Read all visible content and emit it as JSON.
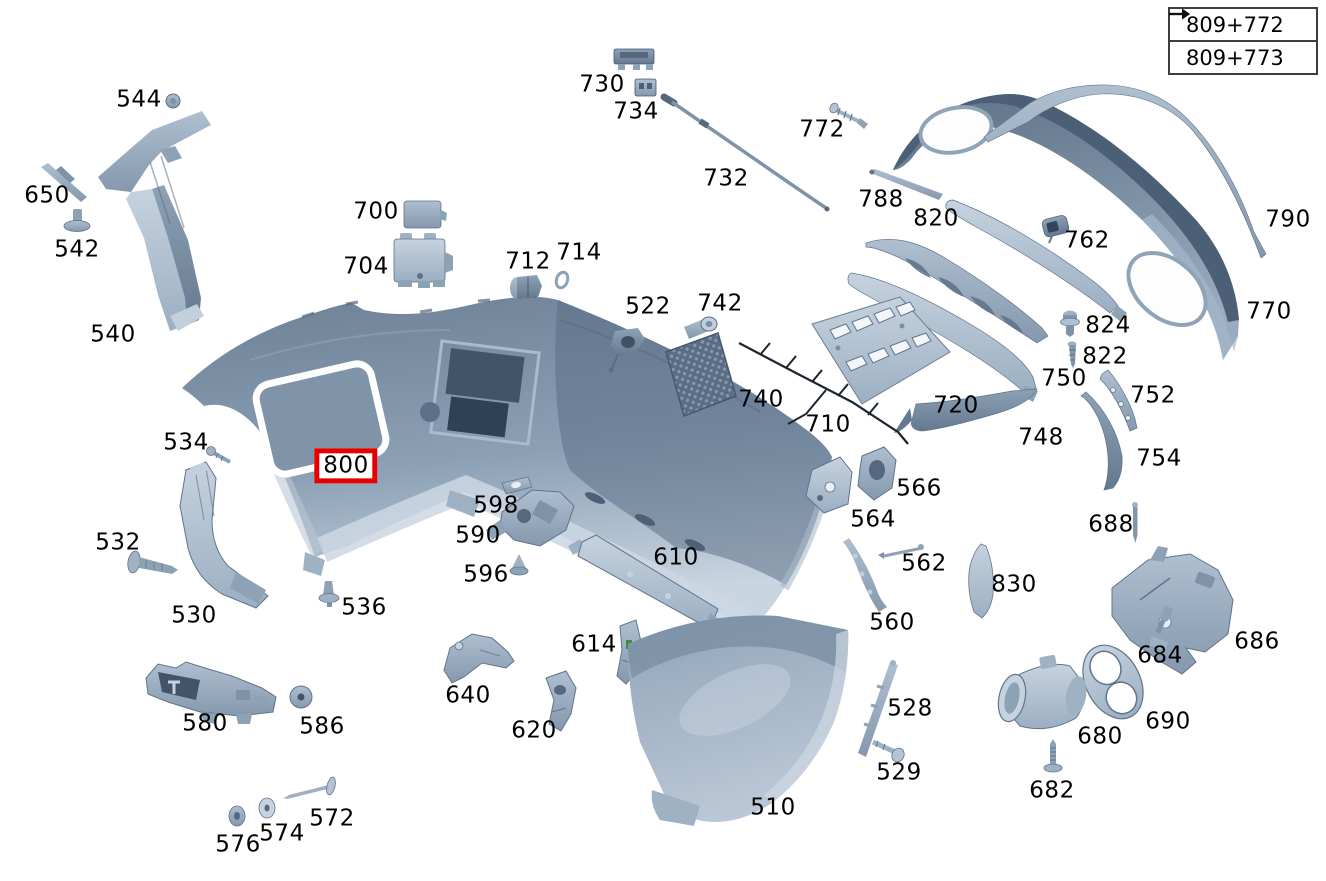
{
  "reference_links": [
    {
      "label": "809+772"
    },
    {
      "label": "809+773"
    }
  ],
  "selected_part": "800",
  "colors": {
    "highlight_box": "#e60000",
    "part_base": "#9fb2c4",
    "part_dark": "#5d7187",
    "part_light": "#c6d2df",
    "label_text": "#000000",
    "recess_outline": "#ffffff"
  },
  "part_labels": [
    {
      "text": "544",
      "x": 139,
      "y": 100
    },
    {
      "text": "650",
      "x": 47,
      "y": 196
    },
    {
      "text": "542",
      "x": 77,
      "y": 250
    },
    {
      "text": "540",
      "x": 113,
      "y": 335
    },
    {
      "text": "700",
      "x": 376,
      "y": 212
    },
    {
      "text": "704",
      "x": 366,
      "y": 267
    },
    {
      "text": "712",
      "x": 528,
      "y": 262
    },
    {
      "text": "714",
      "x": 579,
      "y": 253
    },
    {
      "text": "730",
      "x": 602,
      "y": 85
    },
    {
      "text": "734",
      "x": 636,
      "y": 112
    },
    {
      "text": "732",
      "x": 726,
      "y": 179
    },
    {
      "text": "772",
      "x": 822,
      "y": 130
    },
    {
      "text": "788",
      "x": 881,
      "y": 200
    },
    {
      "text": "820",
      "x": 936,
      "y": 219
    },
    {
      "text": "762",
      "x": 1087,
      "y": 241
    },
    {
      "text": "790",
      "x": 1288,
      "y": 220
    },
    {
      "text": "770",
      "x": 1269,
      "y": 312
    },
    {
      "text": "824",
      "x": 1108,
      "y": 326
    },
    {
      "text": "822",
      "x": 1105,
      "y": 357
    },
    {
      "text": "750",
      "x": 1064,
      "y": 379
    },
    {
      "text": "748",
      "x": 1041,
      "y": 438
    },
    {
      "text": "752",
      "x": 1153,
      "y": 396
    },
    {
      "text": "754",
      "x": 1159,
      "y": 459
    },
    {
      "text": "522",
      "x": 648,
      "y": 307
    },
    {
      "text": "742",
      "x": 720,
      "y": 304
    },
    {
      "text": "740",
      "x": 761,
      "y": 400
    },
    {
      "text": "710",
      "x": 828,
      "y": 425
    },
    {
      "text": "720",
      "x": 956,
      "y": 406
    },
    {
      "text": "800",
      "x": 346,
      "y": 466,
      "selected": true
    },
    {
      "text": "534",
      "x": 186,
      "y": 443
    },
    {
      "text": "532",
      "x": 118,
      "y": 543
    },
    {
      "text": "530",
      "x": 194,
      "y": 616
    },
    {
      "text": "536",
      "x": 364,
      "y": 608
    },
    {
      "text": "598",
      "x": 496,
      "y": 506
    },
    {
      "text": "590",
      "x": 478,
      "y": 536
    },
    {
      "text": "596",
      "x": 486,
      "y": 575
    },
    {
      "text": "610",
      "x": 676,
      "y": 558
    },
    {
      "text": "614",
      "x": 594,
      "y": 645
    },
    {
      "text": "640",
      "x": 468,
      "y": 696
    },
    {
      "text": "620",
      "x": 534,
      "y": 731
    },
    {
      "text": "566",
      "x": 919,
      "y": 489
    },
    {
      "text": "564",
      "x": 873,
      "y": 520
    },
    {
      "text": "562",
      "x": 924,
      "y": 564
    },
    {
      "text": "560",
      "x": 892,
      "y": 623
    },
    {
      "text": "830",
      "x": 1014,
      "y": 585
    },
    {
      "text": "688",
      "x": 1111,
      "y": 525
    },
    {
      "text": "686",
      "x": 1257,
      "y": 642
    },
    {
      "text": "684",
      "x": 1160,
      "y": 656
    },
    {
      "text": "690",
      "x": 1168,
      "y": 722
    },
    {
      "text": "680",
      "x": 1100,
      "y": 737
    },
    {
      "text": "682",
      "x": 1052,
      "y": 791
    },
    {
      "text": "580",
      "x": 205,
      "y": 724
    },
    {
      "text": "586",
      "x": 322,
      "y": 727
    },
    {
      "text": "576",
      "x": 238,
      "y": 845
    },
    {
      "text": "574",
      "x": 282,
      "y": 834
    },
    {
      "text": "572",
      "x": 332,
      "y": 819
    },
    {
      "text": "528",
      "x": 910,
      "y": 709
    },
    {
      "text": "529",
      "x": 899,
      "y": 773
    },
    {
      "text": "510",
      "x": 773,
      "y": 808
    }
  ]
}
